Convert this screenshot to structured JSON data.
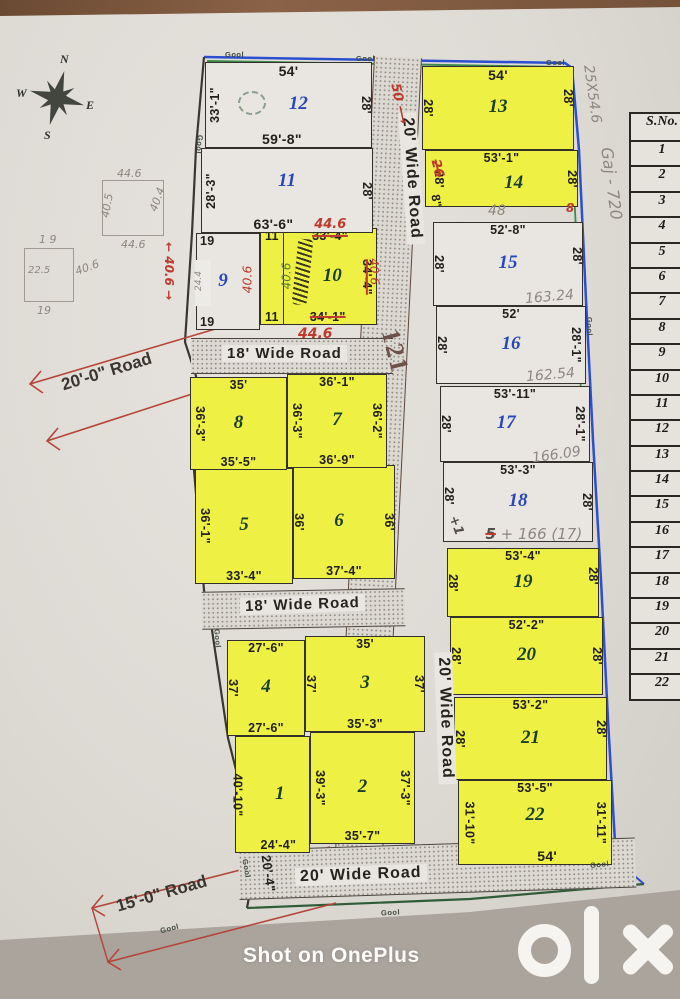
{
  "photo": {
    "watermark": "Shot on OnePlus",
    "brand": "olx"
  },
  "compass": {
    "n": "N",
    "e": "E",
    "s": "S",
    "w": "W"
  },
  "labels": {
    "gool": "Gool"
  },
  "roads": {
    "central": "20' Wide Road",
    "bottom": "20' Wide Road",
    "band1": "18' Wide Road",
    "band2": "18' Wide Road",
    "diag_top": "20'-0\" Road",
    "diag_bottom": "15'-0\" Road"
  },
  "plots": [
    {
      "num": "1",
      "left": "40'-10\"",
      "bottom": "24'-4\""
    },
    {
      "num": "2",
      "left": "39'-3\"",
      "right": "37'-3\"",
      "bottom": "35'-7\""
    },
    {
      "num": "3",
      "top": "35'",
      "left": "37'",
      "right": "37'",
      "bottom": "35'-3\""
    },
    {
      "num": "4",
      "top": "27'-6\"",
      "left": "37'",
      "bottom": "27'-6\""
    },
    {
      "num": "5",
      "left": "36'-1\"",
      "bottom": "33'-4\""
    },
    {
      "num": "6",
      "left": "36'",
      "right": "36'",
      "bottom": "37'-4\""
    },
    {
      "num": "7",
      "top": "36'-1\"",
      "left": "36'-3\"",
      "right": "36'-2\"",
      "bottom": "36'-9\""
    },
    {
      "num": "8",
      "top": "35'",
      "left": "36'-3\"",
      "bottom": "35'-5\""
    },
    {
      "num": "9",
      "tl": "19",
      "bl": "19",
      "red": "40.6",
      "patch": "24.4"
    },
    {
      "num": "10",
      "top": "33'-4\"",
      "right": "34'-4\"",
      "bottom": "34'-1\"",
      "strip_top": "11",
      "strip_bottom": "11",
      "green": "40.6"
    },
    {
      "num": "11",
      "left": "28'-3\"",
      "right": "28'",
      "bottom": "63'-6\""
    },
    {
      "num": "12",
      "top": "54'",
      "left": "33'-1\"",
      "right": "28'",
      "bottom": "59'-8\""
    },
    {
      "num": "13",
      "top": "54'",
      "left": "28'",
      "right": "28'"
    },
    {
      "num": "14",
      "top": "53'-1\"",
      "left": "28'",
      "right": "28'",
      "struck": "26",
      "corner": "8\""
    },
    {
      "num": "15",
      "top": "52'-8\"",
      "left": "28'",
      "right": "28'",
      "pencil": "163.24"
    },
    {
      "num": "16",
      "top": "52'",
      "left": "28'",
      "right": "28'-1\"",
      "pencil": "162.54"
    },
    {
      "num": "17",
      "top": "53'-11\"",
      "left": "28'",
      "right": "28'-1\"",
      "pencil": "166.09"
    },
    {
      "num": "18",
      "top": "53'-3\"",
      "left": "28'",
      "right": "28'",
      "plus": "+1",
      "pencil_struck": "5",
      "pencil": "+ 166 (17)"
    },
    {
      "num": "19",
      "top": "53'-4\"",
      "left": "28'",
      "right": "28'"
    },
    {
      "num": "20",
      "top": "52'-2\"",
      "left": "28'",
      "right": "28'"
    },
    {
      "num": "21",
      "top": "53'-2\"",
      "left": "28'",
      "right": "28'"
    },
    {
      "num": "22",
      "top": "53'-5\"",
      "left": "31'-10\"",
      "right": "31'-11\"",
      "bottom": "54'"
    }
  ],
  "table": {
    "header": "S.No.",
    "rows": [
      "1",
      "2",
      "3",
      "4",
      "5",
      "6",
      "7",
      "8",
      "9",
      "10",
      "11",
      "12",
      "13",
      "14",
      "15",
      "16",
      "17",
      "18",
      "19",
      "20",
      "21",
      "22"
    ]
  },
  "annotations": {
    "a25x54": "25X54.6",
    "gaj720": "Gaj - 720",
    "red50": "50 ⟶",
    "red121": "121",
    "red406road": "40.6",
    "red406left": "← 40.6 →",
    "dim204": "20'-4\"",
    "red446a": "44.6",
    "red446b": "44.6",
    "pencil48": "48",
    "red8": "8",
    "sk1": {
      "top": "44.6",
      "left": "40.5",
      "right": "40.4",
      "bottom": "44.6"
    },
    "sk2": {
      "top": "1 9",
      "left": "22.5",
      "right": "40.6",
      "bottom": "19"
    }
  }
}
